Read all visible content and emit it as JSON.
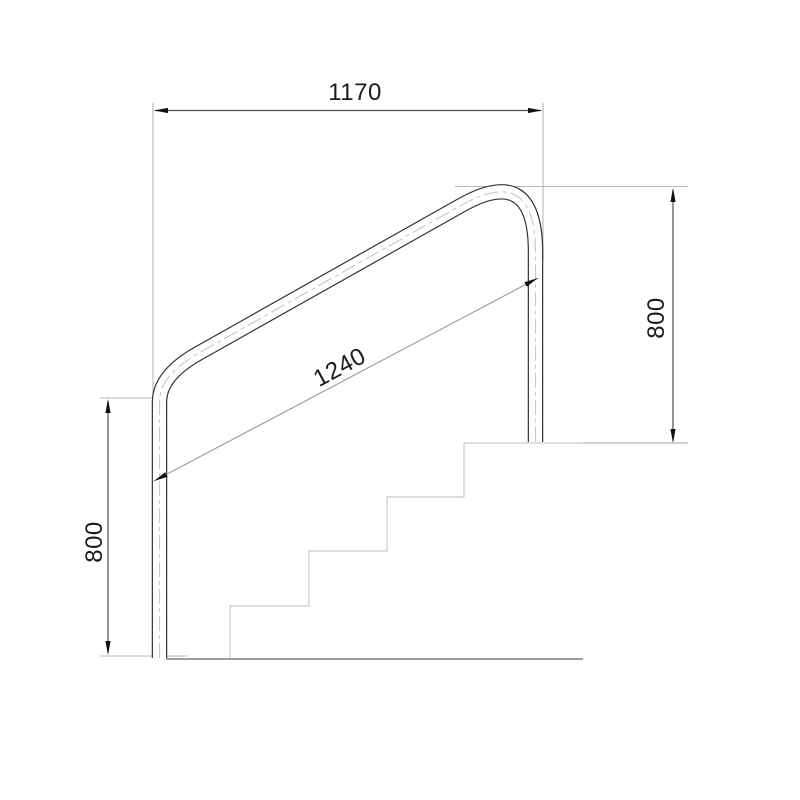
{
  "drawing": {
    "type": "technical-drawing",
    "subject": "stair handrail side elevation with staircase profile",
    "dimensions": {
      "top_width": "1170",
      "rail_diagonal_length": "1240",
      "right_height": "800",
      "left_height": "800"
    },
    "stairs": {
      "step_count": 4
    },
    "colors": {
      "background": "#ffffff",
      "rail_outline": "#333333",
      "rail_centerline": "#c8c8c8",
      "dimension_line": "#4d4d4d",
      "diagonal_dimension_line": "#a0a0a0",
      "extension_line": "#b8b8b8",
      "stairs_line": "#cacaca",
      "floor_line": "#9f9f9f",
      "arrow": "#111111",
      "text": "#1b1b1b"
    }
  }
}
